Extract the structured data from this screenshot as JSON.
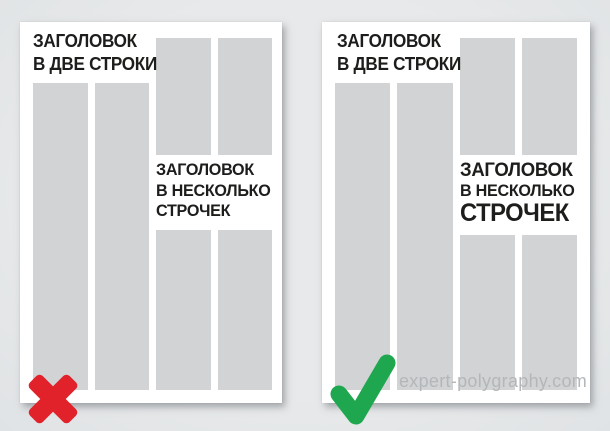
{
  "watermark": {
    "text": "expert-polygraphy.com"
  },
  "colors": {
    "background": "#e7e9ea",
    "page": "#ffffff",
    "column_placeholder": "#d1d3d4",
    "headline_text": "#1d1d1b",
    "cross": "#e2222a",
    "check": "#1fa750",
    "watermark": "#b4b7b9"
  },
  "icons": {
    "wrong_verdict": "red-cross-icon",
    "correct_verdict": "green-check-icon"
  },
  "examples": {
    "wrong": {
      "two_line_headline": [
        "ЗАГОЛОВОК",
        "В ДВЕ СТРОКИ"
      ],
      "multi_line_headline": [
        "ЗАГОЛОВОК",
        "В НЕСКОЛЬКО",
        "СТРОЧЕК"
      ]
    },
    "correct": {
      "two_line_headline": [
        "ЗАГОЛОВОК",
        "В ДВЕ СТРОКИ"
      ],
      "multi_line_headline": [
        "ЗАГОЛОВОК",
        "В НЕСКОЛЬКО",
        "СТРОЧЕК"
      ]
    }
  }
}
